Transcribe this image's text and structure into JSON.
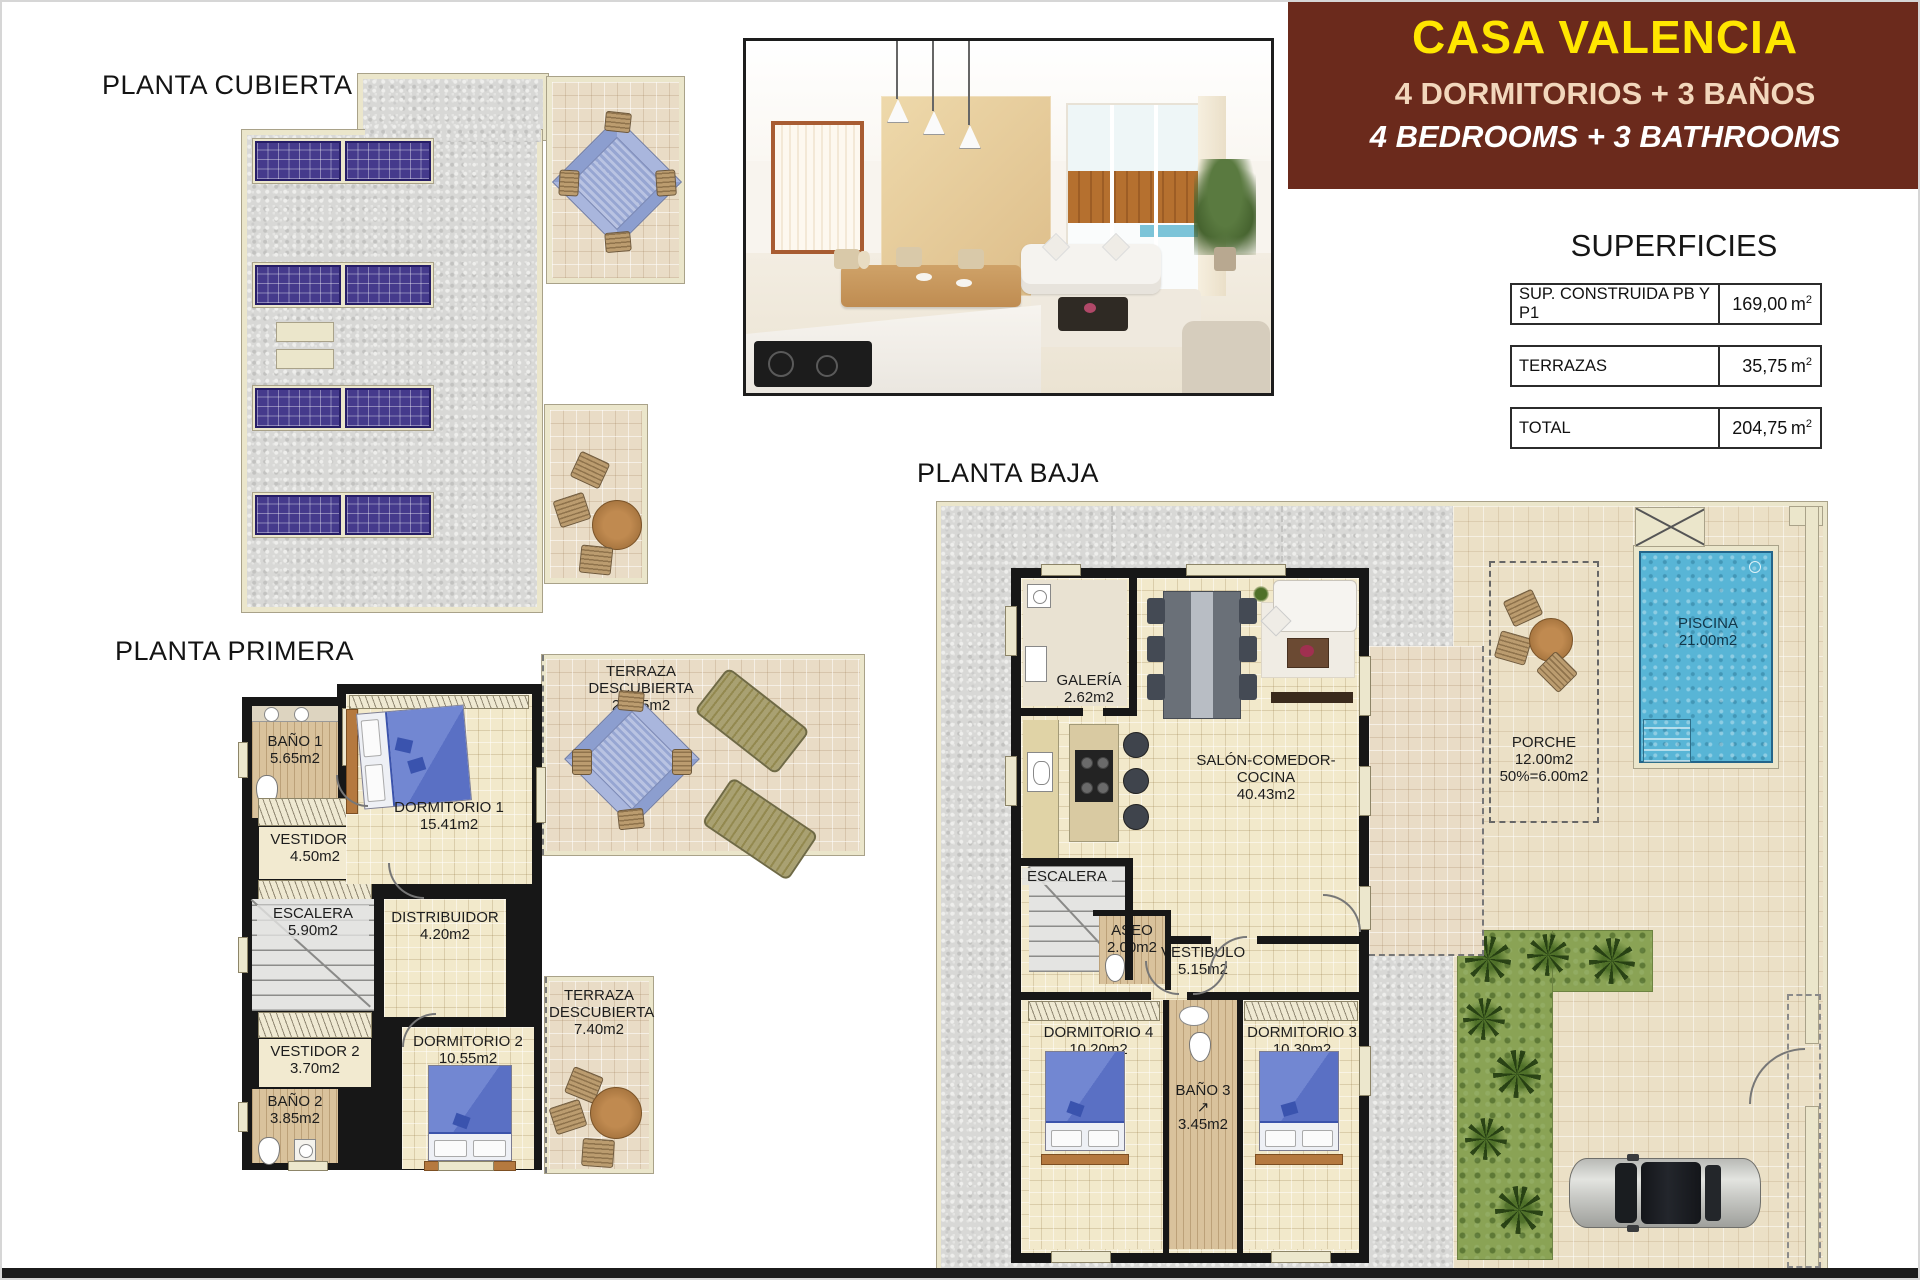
{
  "colors": {
    "header_bg": "#6B2A1C",
    "header_title_yellow": "#FFE600",
    "header_subtitle_cream": "#F2D7BC",
    "header_subtitle_white": "#FFFFFF",
    "wall_black": "#171717",
    "deck_cream": "#EBE6CB",
    "pool_blue": "#58B5D6",
    "garden_green": "#8AA355",
    "solar_panel_purple": "#453A8C"
  },
  "header": {
    "title": "CASA VALENCIA",
    "subtitle_es": "4 DORMITORIOS + 3 BAÑOS",
    "subtitle_en": "4 BEDROOMS + 3 BATHROOMS"
  },
  "superficies": {
    "title": "SUPERFICIES",
    "rows": [
      {
        "label": "SUP. CONSTRUIDA PB Y P1",
        "value": "169,00",
        "unit": "m",
        "unit_exp": "2"
      },
      {
        "label": "TERRAZAS",
        "value": "35,75",
        "unit": "m",
        "unit_exp": "2"
      },
      {
        "label": "TOTAL",
        "value": "204,75",
        "unit": "m",
        "unit_exp": "2"
      }
    ]
  },
  "plan_cubierta": {
    "title": "PLANTA CUBIERTA"
  },
  "plan_primera": {
    "title": "PLANTA PRIMERA",
    "bano1": {
      "name": "BAÑO 1",
      "area": "5.65m2"
    },
    "vestidor1": {
      "name": "VESTIDOR 1",
      "area": "4.50m2"
    },
    "escalera": {
      "name": "ESCALERA",
      "area": "5.90m2"
    },
    "dormitorio1": {
      "name": "DORMITORIO 1",
      "area": "15.41m2"
    },
    "distribuidor": {
      "name": "DISTRIBUIDOR",
      "area": "4.20m2"
    },
    "terraza_grande": {
      "name": "TERRAZA DESCUBIERTA",
      "area": "28.35m2"
    },
    "vestidor2": {
      "name": "VESTIDOR 2",
      "area": "3.70m2"
    },
    "bano2": {
      "name": "BAÑO 2",
      "area": "3.85m2"
    },
    "dormitorio2": {
      "name": "DORMITORIO 2",
      "area": "10.55m2"
    },
    "terraza_pequena": {
      "name": "TERRAZA DESCUBIERTA",
      "area": "7.40m2"
    }
  },
  "plan_baja": {
    "title": "PLANTA BAJA",
    "galeria": {
      "name": "GALERÍA",
      "area": "2.62m2"
    },
    "salon": {
      "name": "SALÓN-COMEDOR-COCINA",
      "area": "40.43m2"
    },
    "escalera": {
      "name": "ESCALERA"
    },
    "aseo": {
      "name": "ASEO",
      "area": "2.00m2"
    },
    "vestibulo": {
      "name": "VESTIBULO",
      "area": "5.15m2"
    },
    "dormitorio4": {
      "name": "DORMITORIO 4",
      "area": "10.20m2"
    },
    "dormitorio3": {
      "name": "DORMITORIO 3",
      "area": "10.30m2"
    },
    "bano3": {
      "name": "BAÑO 3",
      "arrow": "↗",
      "area": "3.45m2"
    },
    "porche": {
      "name": "PORCHE",
      "area": "12.00m2",
      "area_pct": "50%=6.00m2"
    },
    "piscina": {
      "name": "PISCINA",
      "area": "21.00m2"
    }
  }
}
